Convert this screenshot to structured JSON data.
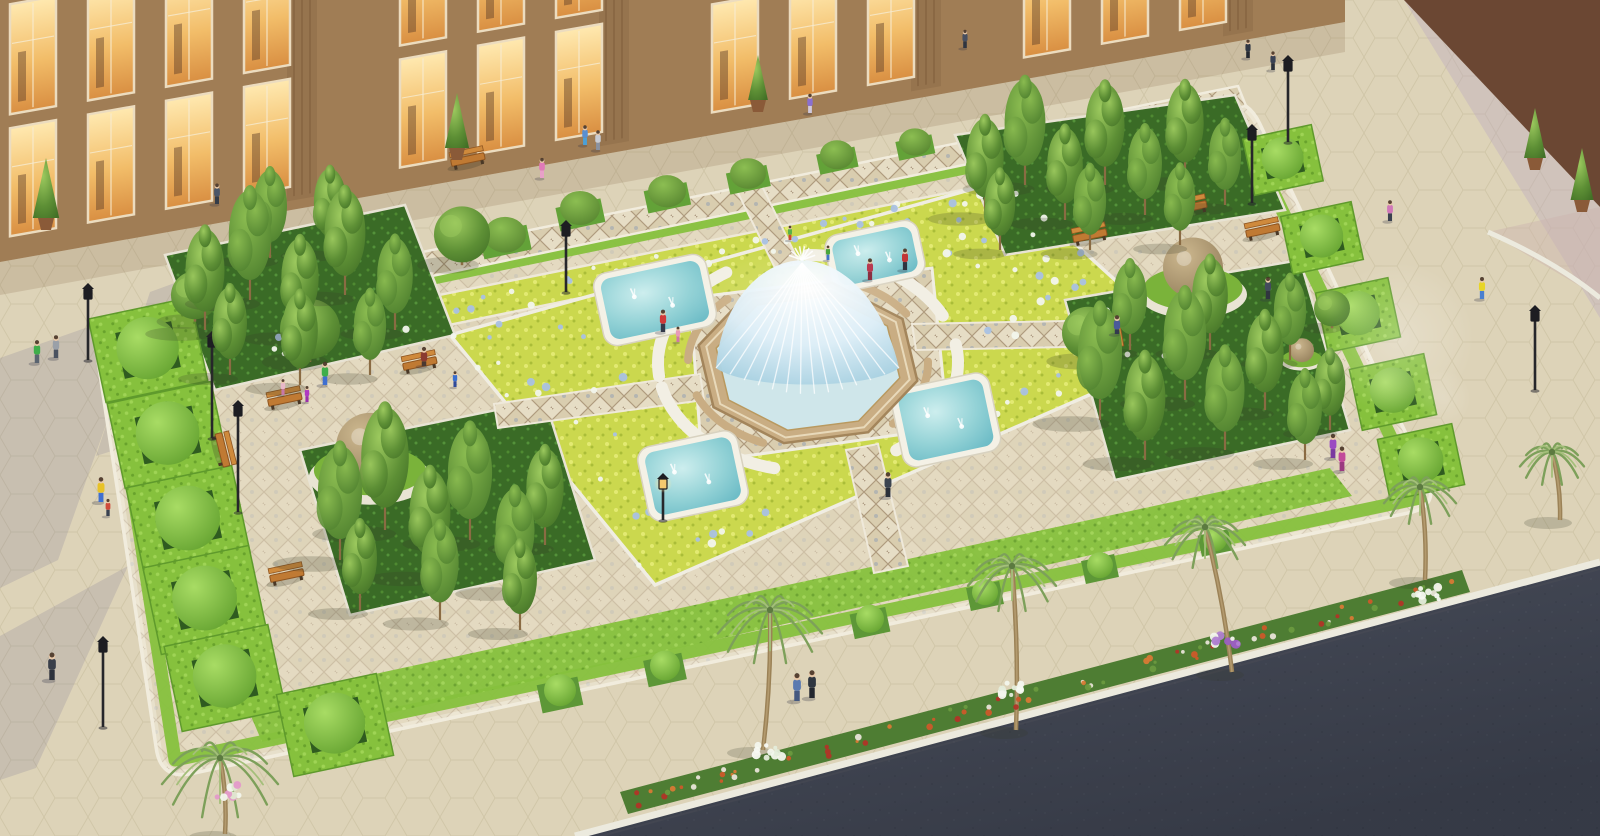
{
  "scene": {
    "kind": "aerial-architectural-rendering",
    "subject": "formal plaza garden with central dome fountain, four corner pools, parterre flower beds, hedge topiary, tree bosquets, palm-lined sidewalk, road, and lit retail facade"
  },
  "colors": {
    "plaza_pavement": "#ddd3b8",
    "plaza_line": "#c4b998",
    "plaza_shadow": "rgba(95,88,135,0.16)",
    "road_asphalt": "#4a4f5c",
    "curb": "#eceade",
    "garden_walk": "#e2d8bf",
    "stone_border": "#f1ecdd",
    "hedge_green": "#86c13d",
    "hedge_dark": "#5f9a2c",
    "grass_dark": "#3a6b26",
    "chartreuse": "#cbd84e",
    "flower_white": "#f2f5ec",
    "flower_blue": "#a9c1e3",
    "tree_green": "#5d8f35",
    "trunk": "#8a6b43",
    "palm_frond": "#7da05a",
    "palm_trunk": "#9b8257",
    "pool_rim": "#f4f1e6",
    "fountain_stone": "#c9ad83",
    "building_wall": "#a07d55",
    "building_wall2": "#6b4733",
    "window_frame": "#ecdcbf",
    "bench_wood": "#c07a33",
    "lamp_black": "#26262a",
    "sphere_stone": "#b7a179",
    "flowerbed_green": "#4e7d33",
    "flower_orange": "#cc5a2a",
    "flower_red": "#b03527",
    "flower_purple": "#b07fd1",
    "skin": "#e8c8a8"
  },
  "layout_regions": {
    "plaza_shadows": [
      [
        [
          0,
          358
        ],
        [
          148,
          306
        ],
        [
          58,
          560
        ],
        [
          0,
          588
        ]
      ],
      [
        [
          0,
          636
        ],
        [
          128,
          566
        ],
        [
          36,
          768
        ],
        [
          0,
          780
        ]
      ],
      [
        [
          150,
          292
        ],
        [
          260,
          252
        ],
        [
          210,
          420
        ],
        [
          96,
          456
        ]
      ]
    ],
    "road": [
      [
        575,
        836
      ],
      [
        1600,
        562
      ],
      [
        1600,
        836
      ]
    ],
    "flower_strip": [
      [
        620,
        792
      ],
      [
        1462,
        570
      ],
      [
        1470,
        592
      ],
      [
        628,
        814
      ]
    ],
    "lavender_walk": [
      [
        1404,
        0
      ],
      [
        1600,
        207
      ],
      [
        1600,
        318
      ]
    ],
    "pink_ramp": [
      [
        1488,
        232
      ],
      [
        1600,
        298
      ],
      [
        1600,
        207
      ]
    ],
    "curb2_path": "M1488,232 Q1556,262 1600,298",
    "building_wall": [
      [
        0,
        0
      ],
      [
        1345,
        0
      ],
      [
        1345,
        22
      ],
      [
        0,
        262
      ]
    ],
    "building_shade": [
      [
        0,
        262
      ],
      [
        1345,
        22
      ],
      [
        1345,
        52
      ],
      [
        0,
        295
      ]
    ],
    "building2": [
      [
        1404,
        0
      ],
      [
        1600,
        0
      ],
      [
        1600,
        207
      ]
    ],
    "garden_border_path": "M124,326 L1216,103 Q1245,97 1258,124 L1425,478 Q1438,505 1409,511 L191,772 Q162,778 158,748 L100,362 Q95,332 124,326 Z",
    "hedge_ring": [
      [
        110,
        345
      ],
      [
        1235,
        112
      ],
      [
        1420,
        498
      ],
      [
        175,
        760
      ]
    ],
    "top_mosaic_band": [
      [
        108,
        316
      ],
      [
        1238,
        86
      ],
      [
        1246,
        106
      ],
      [
        116,
        342
      ]
    ],
    "top_bed": [
      [
        190,
        345
      ],
      [
        1002,
        182
      ],
      [
        1018,
        208
      ],
      [
        206,
        375
      ]
    ],
    "bottom_band": [
      [
        245,
        702
      ],
      [
        1330,
        468
      ],
      [
        1352,
        496
      ],
      [
        262,
        742
      ]
    ],
    "parterre": [
      [
        450,
        335
      ],
      [
        1005,
        180
      ],
      [
        1192,
        350
      ],
      [
        655,
        585
      ]
    ],
    "center_mosaic": [
      [
        690,
        298
      ],
      [
        932,
        268
      ],
      [
        948,
        428
      ],
      [
        702,
        462
      ]
    ],
    "walks": [
      [
        [
          775,
          268
        ],
        [
          800,
          264
        ],
        [
          762,
          186
        ],
        [
          737,
          191
        ]
      ],
      [
        [
          846,
          450
        ],
        [
          878,
          444
        ],
        [
          908,
          566
        ],
        [
          874,
          573
        ]
      ],
      [
        [
          700,
          374
        ],
        [
          704,
          400
        ],
        [
          498,
          428
        ],
        [
          494,
          404
        ]
      ],
      [
        [
          912,
          324
        ],
        [
          916,
          350
        ],
        [
          1118,
          346
        ],
        [
          1114,
          320
        ]
      ]
    ],
    "groves": [
      [
        [
          165,
          255
        ],
        [
          405,
          205
        ],
        [
          455,
          335
        ],
        [
          215,
          390
        ]
      ],
      [
        [
          300,
          450
        ],
        [
          545,
          400
        ],
        [
          595,
          560
        ],
        [
          350,
          615
        ]
      ],
      [
        [
          955,
          135
        ],
        [
          1235,
          95
        ],
        [
          1285,
          210
        ],
        [
          1005,
          255
        ]
      ],
      [
        [
          1065,
          300
        ],
        [
          1300,
          260
        ],
        [
          1350,
          430
        ],
        [
          1115,
          480
        ]
      ]
    ]
  },
  "objects": {
    "fountain": {
      "cx": 808,
      "cy": 363,
      "rx": 112,
      "ry": 82,
      "rot": -10
    },
    "pools_fields": [
      "cx",
      "cy",
      "w",
      "h"
    ],
    "pools": [
      [
        655,
        300,
        115,
        74
      ],
      [
        875,
        256,
        95,
        58
      ],
      [
        946,
        420,
        100,
        80
      ],
      [
        693,
        476,
        102,
        76
      ]
    ],
    "spheres": [
      [
        370,
        452,
        34
      ],
      [
        1193,
        272,
        30
      ],
      [
        1302,
        352,
        12
      ]
    ],
    "hedge_cubes_fields": [
      "x",
      "y",
      "size"
    ],
    "hedge_cubes": [
      [
        148,
        350,
        104
      ],
      [
        168,
        435,
        106
      ],
      [
        188,
        520,
        108
      ],
      [
        205,
        600,
        108
      ],
      [
        225,
        678,
        106
      ],
      [
        335,
        725,
        102
      ],
      [
        1283,
        160,
        70
      ],
      [
        1322,
        238,
        72
      ],
      [
        1358,
        315,
        74
      ],
      [
        1393,
        392,
        76
      ],
      [
        1421,
        462,
        76
      ]
    ],
    "edge_balls": [
      [
        560,
        695,
        16
      ],
      [
        665,
        670,
        15
      ],
      [
        870,
        623,
        14
      ],
      [
        985,
        596,
        13
      ],
      [
        1100,
        569,
        13
      ],
      [
        1215,
        543,
        12
      ]
    ],
    "plaza_domes": [
      [
        505,
        240,
        21
      ],
      [
        580,
        213,
        20
      ],
      [
        667,
        196,
        19
      ],
      [
        748,
        178,
        18
      ],
      [
        837,
        159,
        17
      ],
      [
        915,
        146,
        16
      ]
    ],
    "potted_cones": [
      [
        46,
        218,
        60
      ],
      [
        457,
        148,
        55
      ],
      [
        758,
        100,
        45
      ],
      [
        1535,
        158,
        50
      ],
      [
        1582,
        200,
        52
      ]
    ],
    "benches_fields": [
      "x",
      "y",
      "angle_deg"
    ],
    "benches": [
      [
        285,
        400,
        -12
      ],
      [
        420,
        364,
        -12
      ],
      [
        222,
        450,
        76
      ],
      [
        287,
        576,
        -12
      ],
      [
        468,
        160,
        -12
      ],
      [
        1090,
        236,
        -12
      ],
      [
        1190,
        208,
        -12
      ],
      [
        1263,
        231,
        -12
      ],
      [
        1110,
        331,
        80
      ]
    ],
    "lamps_fields": [
      "x",
      "y_base",
      "pole_h",
      "lit"
    ],
    "lamps": [
      [
        212,
        438,
        92,
        0
      ],
      [
        238,
        512,
        97,
        0
      ],
      [
        103,
        727,
        76,
        0
      ],
      [
        88,
        360,
        62,
        0
      ],
      [
        1288,
        142,
        72,
        0
      ],
      [
        1252,
        203,
        64,
        0
      ],
      [
        1535,
        390,
        70,
        0
      ],
      [
        663,
        520,
        32,
        1
      ],
      [
        566,
        292,
        57,
        0
      ]
    ],
    "trees_columnar_fields": [
      "x",
      "y_base",
      "height"
    ],
    "trees_columnar": [
      [
        205,
        330,
        115
      ],
      [
        250,
        300,
        125
      ],
      [
        300,
        335,
        110
      ],
      [
        345,
        295,
        120
      ],
      [
        395,
        330,
        105
      ],
      [
        230,
        375,
        100
      ],
      [
        300,
        385,
        105
      ],
      [
        370,
        375,
        95
      ],
      [
        270,
        258,
        100
      ],
      [
        330,
        252,
        95
      ],
      [
        340,
        560,
        130
      ],
      [
        385,
        530,
        140
      ],
      [
        430,
        575,
        120
      ],
      [
        470,
        540,
        130
      ],
      [
        515,
        590,
        115
      ],
      [
        545,
        545,
        110
      ],
      [
        360,
        610,
        100
      ],
      [
        440,
        620,
        110
      ],
      [
        520,
        630,
        100
      ],
      [
        985,
        215,
        110
      ],
      [
        1025,
        185,
        120
      ],
      [
        1065,
        220,
        105
      ],
      [
        1105,
        185,
        115
      ],
      [
        1145,
        215,
        100
      ],
      [
        1185,
        180,
        110
      ],
      [
        1225,
        205,
        95
      ],
      [
        1000,
        250,
        90
      ],
      [
        1090,
        250,
        95
      ],
      [
        1180,
        245,
        90
      ],
      [
        1100,
        420,
        130
      ],
      [
        1145,
        460,
        120
      ],
      [
        1185,
        400,
        125
      ],
      [
        1225,
        450,
        115
      ],
      [
        1265,
        410,
        110
      ],
      [
        1305,
        460,
        100
      ],
      [
        1130,
        350,
        100
      ],
      [
        1210,
        350,
        105
      ],
      [
        1290,
        360,
        95
      ],
      [
        1330,
        430,
        90
      ]
    ],
    "trees_round": [
      [
        310,
        335,
        30
      ],
      [
        195,
        300,
        24
      ],
      [
        462,
        240,
        28
      ],
      [
        1088,
        338,
        26
      ],
      [
        1332,
        312,
        18
      ]
    ],
    "palms_fields": [
      "trunk_x",
      "trunk_y",
      "crown_x",
      "crown_y",
      "frond_len"
    ],
    "palms": [
      [
        225,
        834,
        220,
        758,
        58
      ],
      [
        763,
        750,
        770,
        610,
        52
      ],
      [
        1016,
        730,
        1012,
        566,
        44
      ],
      [
        1232,
        672,
        1205,
        527,
        40
      ],
      [
        1425,
        580,
        1420,
        487,
        36
      ],
      [
        1560,
        520,
        1552,
        452,
        32
      ]
    ],
    "flower_clusters": [
      [
        770,
        752,
        "white"
      ],
      [
        1016,
        690,
        "white"
      ],
      [
        1425,
        594,
        "white"
      ],
      [
        1228,
        642,
        "purple"
      ],
      [
        228,
        792,
        "pink"
      ]
    ],
    "people_fields": [
      "x",
      "y",
      "shirt",
      "pants",
      "flag(k=kid,s=sitting)"
    ],
    "people": [
      [
        37,
        363,
        "#3fae4a",
        "#5a6470",
        ""
      ],
      [
        56,
        358,
        "#9aa0a8",
        "#4a5260",
        ""
      ],
      [
        101,
        502,
        "#e8c227",
        "#3f6fd0",
        ""
      ],
      [
        52,
        680,
        "#3a3f4a",
        "#2e323c",
        ""
      ],
      [
        108,
        516,
        "#d04a3a",
        "#394150",
        "k"
      ],
      [
        217,
        204,
        "#4a5668",
        "#343c48",
        ""
      ],
      [
        542,
        178,
        "#e07ab8",
        "#e8a0c8",
        ""
      ],
      [
        585,
        145,
        "#5a8fd0",
        "#4aa0d8",
        ""
      ],
      [
        598,
        150,
        "#c8ccd4",
        "#8a92a0",
        ""
      ],
      [
        810,
        113,
        "#8a6fd0",
        "#d0c8dc",
        ""
      ],
      [
        965,
        48,
        "#474f60",
        "#2f3540",
        ""
      ],
      [
        1248,
        58,
        "#2f3744",
        "#23272f",
        ""
      ],
      [
        1273,
        70,
        "#3a4254",
        "#2b303a",
        ""
      ],
      [
        663,
        332,
        "#d03a3a",
        "#33394a",
        ""
      ],
      [
        678,
        342,
        "#e89ab8",
        "#d078a8",
        "k"
      ],
      [
        905,
        270,
        "#c23636",
        "#2f3541",
        ""
      ],
      [
        870,
        280,
        "#b83a50",
        "#8a2f40",
        ""
      ],
      [
        828,
        260,
        "#49a63c",
        "#3f74c9",
        "k"
      ],
      [
        790,
        240,
        "#59b04a",
        "#cc4433",
        "k"
      ],
      [
        888,
        497,
        "#3c4450",
        "#2b303a",
        ""
      ],
      [
        283,
        395,
        "#e8b8c8",
        "#c878a8",
        "k"
      ],
      [
        307,
        402,
        "#b03ac2",
        "#9a30aa",
        "k"
      ],
      [
        325,
        385,
        "#3fae4a",
        "#3f6fd0",
        ""
      ],
      [
        424,
        366,
        "#8a3a30",
        "#4a3830",
        "s"
      ],
      [
        455,
        387,
        "#3a6fd0",
        "#2f4a9a",
        "k"
      ],
      [
        1117,
        334,
        "#4a5a9a",
        "#333a4e",
        "s"
      ],
      [
        1482,
        299,
        "#e8d527",
        "#4a7fd0",
        ""
      ],
      [
        1390,
        221,
        "#d078b8",
        "#3a4150",
        ""
      ],
      [
        1268,
        299,
        "#434b5c",
        "#30353f",
        ""
      ],
      [
        1333,
        458,
        "#9a4ac2",
        "#7a3aa0",
        ""
      ],
      [
        1342,
        471,
        "#c24a9a",
        "#9a3a80",
        ""
      ],
      [
        797,
        701,
        "#5a7ab0",
        "#46597f",
        ""
      ],
      [
        812,
        698,
        "#2f3640",
        "#23272f",
        ""
      ]
    ],
    "flares": [
      [
        1398,
        338,
        76
      ],
      [
        1443,
        398,
        28
      ]
    ]
  },
  "building": {
    "bays": 16,
    "skip": [
      4,
      8,
      12
    ],
    "tiers": [
      [
        6,
        110
      ],
      [
        130,
        108
      ]
    ],
    "columns": [
      302,
      614,
      926,
      1238
    ],
    "bays2": 5
  }
}
